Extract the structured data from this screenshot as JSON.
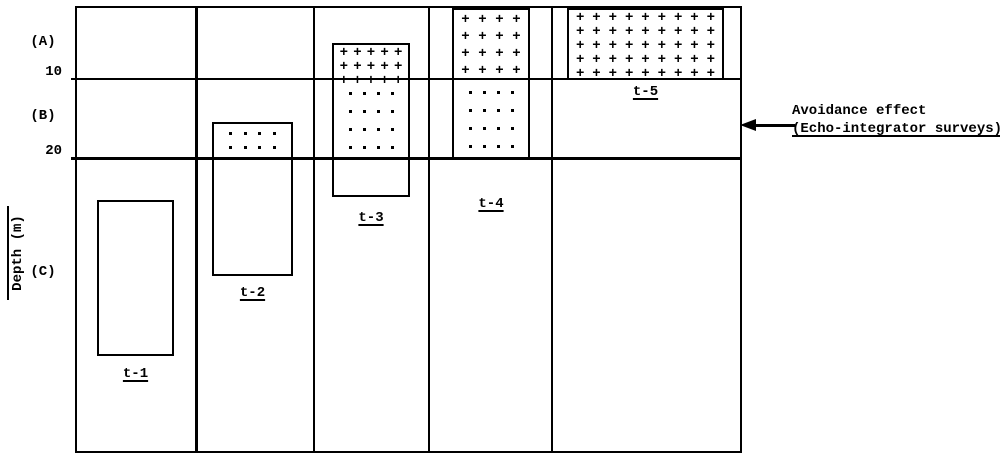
{
  "figure": {
    "depth_axis": {
      "title": "Depth (m)",
      "ticks": [
        "10",
        "20"
      ],
      "zones": [
        {
          "label": "(A)"
        },
        {
          "label": "(B)"
        },
        {
          "label": "(C)"
        }
      ]
    },
    "annotation": {
      "line1": "Avoidance effect",
      "line2": "(Echo-integrator surveys)"
    },
    "periods": [
      {
        "label": "t-1",
        "segments": [
          {
            "pattern": "none"
          }
        ]
      },
      {
        "label": "t-2",
        "segments": [
          {
            "pattern": "dot",
            "rows": 2,
            "cols": 4
          },
          {
            "pattern": "none"
          }
        ]
      },
      {
        "label": "t-3",
        "segments": [
          {
            "pattern": "plus",
            "rows": 3,
            "cols": 5
          },
          {
            "pattern": "dot",
            "rows": 4,
            "cols": 4
          },
          {
            "pattern": "none"
          }
        ]
      },
      {
        "label": "t-4",
        "segments": [
          {
            "pattern": "plus",
            "rows": 4,
            "cols": 4
          },
          {
            "pattern": "dot",
            "rows": 4,
            "cols": 4
          }
        ]
      },
      {
        "label": "t-5",
        "segments": [
          {
            "pattern": "plus",
            "rows": 5,
            "cols": 9
          }
        ]
      }
    ],
    "colors": {
      "ink": "#000000",
      "paper": "#ffffff"
    }
  },
  "chart_data": {
    "type": "table",
    "title": "Vertical distribution of fish schools by depth zone over time periods t-1 to t-5",
    "ylabel": "Depth (m)",
    "depth_ticks_m": [
      10,
      20
    ],
    "depth_zones": [
      {
        "zone": "(A)",
        "range_m": [
          0,
          10
        ],
        "pattern": "plus-hatch"
      },
      {
        "zone": "(B)",
        "range_m": [
          10,
          20
        ],
        "pattern": "dots"
      },
      {
        "zone": "(C)",
        "range_m": [
          20,
          57
        ],
        "pattern": "plain"
      }
    ],
    "series": [
      {
        "name": "t-1",
        "school_depth_range_m": [
          25,
          44
        ],
        "zones_occupied": [
          "C"
        ]
      },
      {
        "name": "t-2",
        "school_depth_range_m": [
          15,
          35
        ],
        "zones_occupied": [
          "B",
          "C"
        ]
      },
      {
        "name": "t-3",
        "school_depth_range_m": [
          5,
          25
        ],
        "zones_occupied": [
          "A",
          "B",
          "C"
        ]
      },
      {
        "name": "t-4",
        "school_depth_range_m": [
          0,
          20
        ],
        "zones_occupied": [
          "A",
          "B"
        ]
      },
      {
        "name": "t-5",
        "school_depth_range_m": [
          0,
          10
        ],
        "zones_occupied": [
          "A"
        ]
      }
    ],
    "annotations": [
      "Avoidance effect (Echo-integrator surveys) — arrow points at empty zone B of period t-5"
    ]
  }
}
